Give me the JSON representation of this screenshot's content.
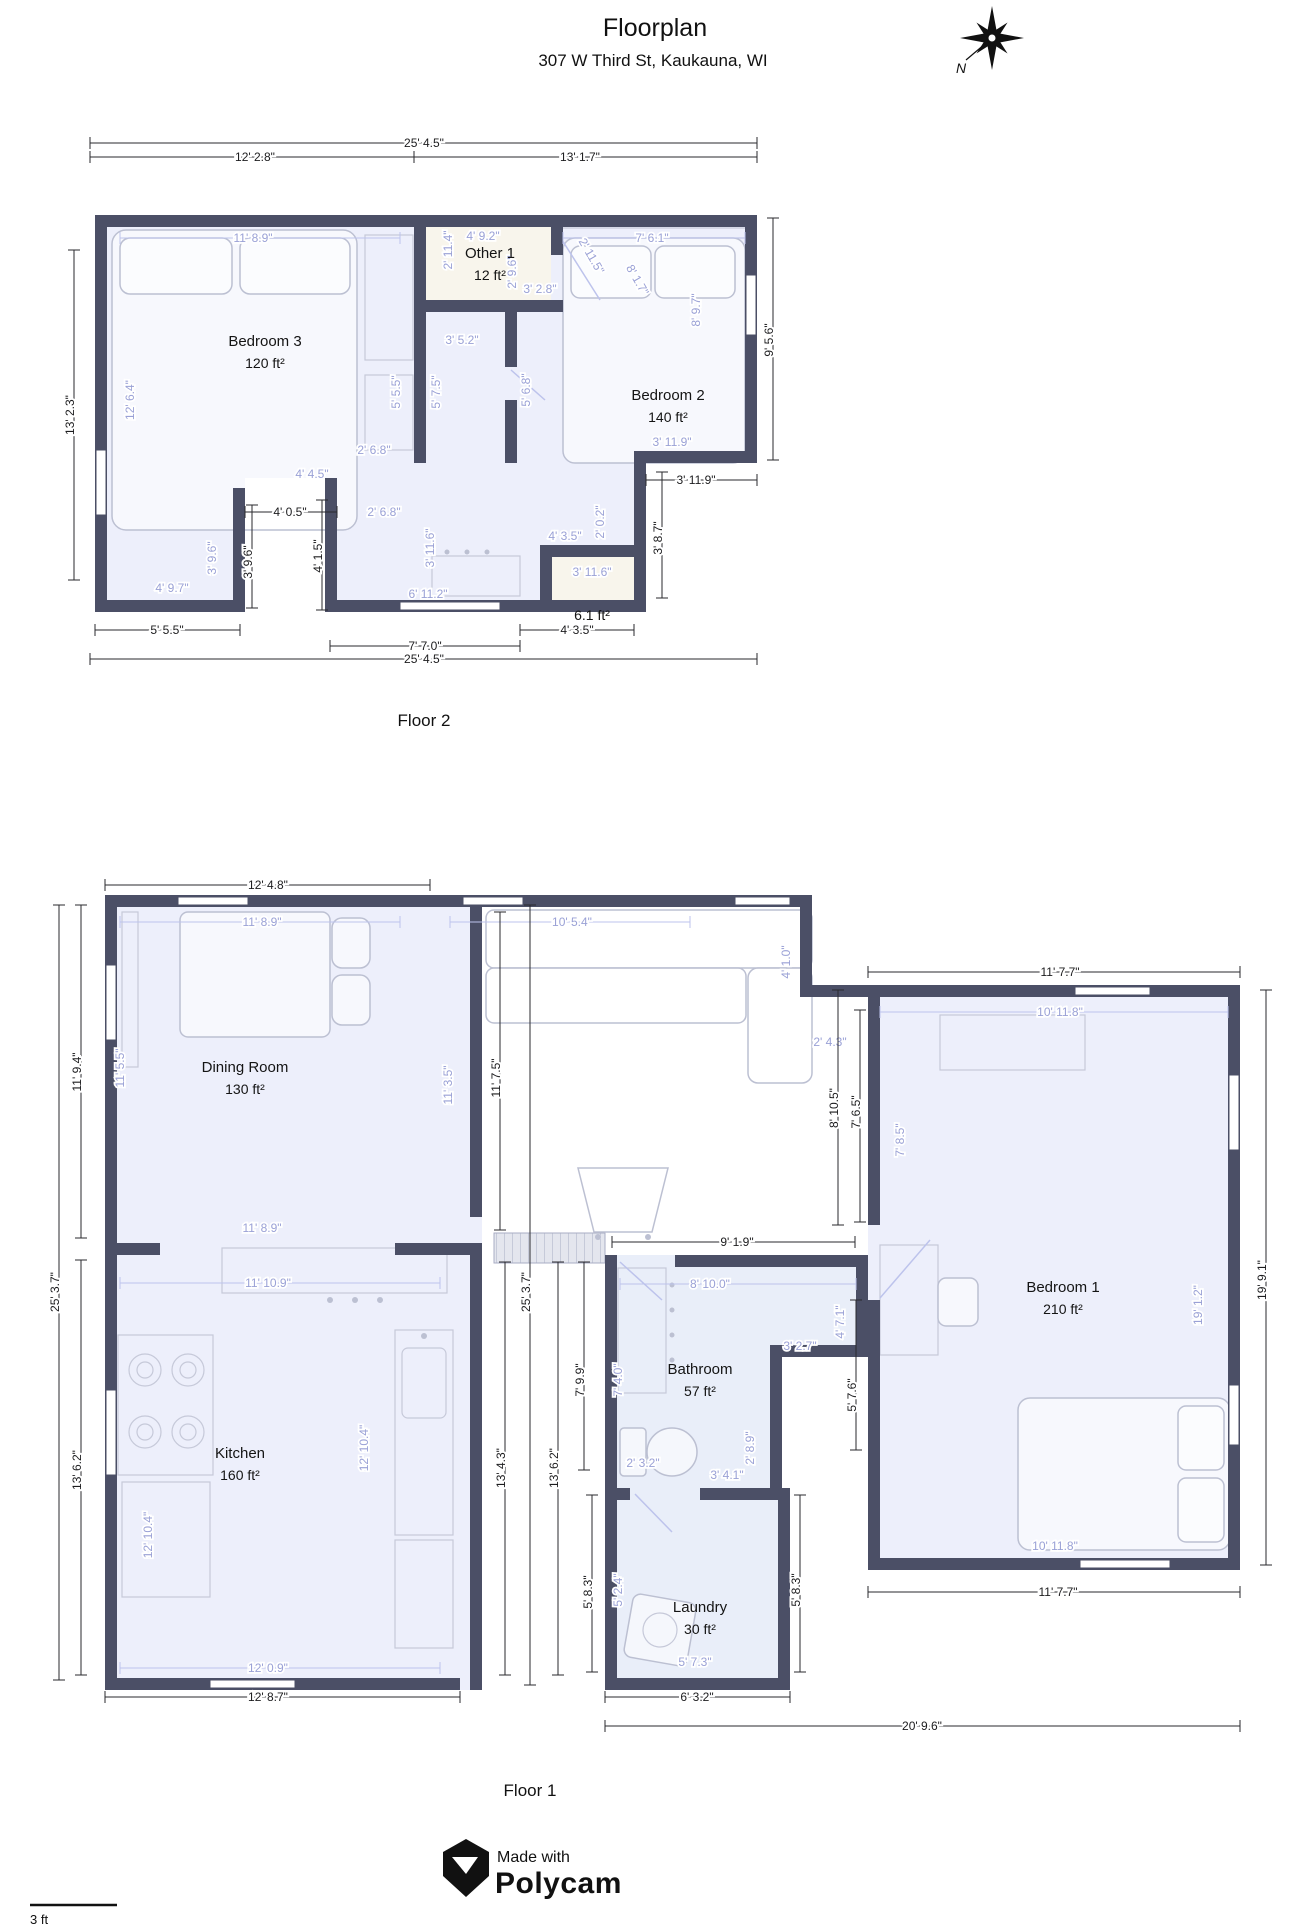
{
  "header": {
    "title": "Floorplan",
    "subtitle": "307 W Third St, Kaukauna, WI"
  },
  "compass": {
    "north_label": "N"
  },
  "colors": {
    "wall": "#4b4f66",
    "dim_black": "#1c1c1e",
    "dim_light": "#9aa1d6",
    "room_fill": "#edeffb",
    "wet_room_fill": "#e9eef9",
    "closet_fill": "#f8f5ec"
  },
  "floor2": {
    "label": "Floor 2",
    "rooms": [
      {
        "name": "Bedroom 3",
        "area": "120 ft²",
        "x": 265,
        "y": 346
      },
      {
        "name": "Other 1",
        "area": "12 ft²",
        "x": 490,
        "y": 258
      },
      {
        "name": "Bedroom 2",
        "area": "140 ft²",
        "x": 668,
        "y": 400
      },
      {
        "name": "",
        "area": "6.1 ft²",
        "x": 592,
        "y": 598
      }
    ],
    "dims": [
      {
        "t": "25' 4.5\"",
        "x": 424,
        "y": 147,
        "c": "b",
        "l": [
          90,
          143,
          757,
          143
        ]
      },
      {
        "t": "12' 2.8\"",
        "x": 255,
        "y": 161,
        "c": "b",
        "l": [
          90,
          157,
          414,
          157
        ]
      },
      {
        "t": "13' 1.7\"",
        "x": 580,
        "y": 161,
        "c": "b",
        "l": [
          414,
          157,
          757,
          157
        ]
      },
      {
        "t": "13' 2.3\"",
        "x": 74,
        "y": 415,
        "r": -90,
        "c": "b",
        "l": [
          74,
          250,
          74,
          580
        ]
      },
      {
        "t": "9' 5.6\"",
        "x": 773,
        "y": 340,
        "r": -90,
        "c": "b",
        "l": [
          773,
          218,
          773,
          460
        ]
      },
      {
        "t": "4' 0.5\"",
        "x": 290,
        "y": 516,
        "c": "b",
        "l": [
          245,
          512,
          337,
          512
        ]
      },
      {
        "t": "4' 1.5\"",
        "x": 322,
        "y": 556,
        "r": -90,
        "c": "b",
        "l": [
          322,
          500,
          322,
          610
        ]
      },
      {
        "t": "3' 9.6\"",
        "x": 252,
        "y": 562,
        "r": -90,
        "c": "b",
        "l": [
          252,
          505,
          252,
          608
        ]
      },
      {
        "t": "3' 9.6\"",
        "x": 216,
        "y": 558,
        "r": -90,
        "c": "l"
      },
      {
        "t": "3' 11.9\"",
        "x": 696,
        "y": 484,
        "c": "b",
        "l": [
          646,
          480,
          757,
          480
        ]
      },
      {
        "t": "3' 11.9\"",
        "x": 672,
        "y": 446,
        "c": "l"
      },
      {
        "t": "3' 8.7\"",
        "x": 662,
        "y": 538,
        "r": -90,
        "c": "b",
        "l": [
          662,
          472,
          662,
          598
        ]
      },
      {
        "t": "5' 5.5\"",
        "x": 167,
        "y": 634,
        "c": "b",
        "l": [
          95,
          630,
          240,
          630
        ]
      },
      {
        "t": "7' 7.0\"",
        "x": 425,
        "y": 650,
        "c": "b",
        "l": [
          330,
          646,
          520,
          646
        ]
      },
      {
        "t": "4' 3.5\"",
        "x": 577,
        "y": 634,
        "c": "b",
        "l": [
          520,
          630,
          634,
          630
        ]
      },
      {
        "t": "25' 4.5\"",
        "x": 424,
        "y": 663,
        "c": "b",
        "l": [
          90,
          659,
          757,
          659
        ]
      },
      {
        "t": "11' 8.9\"",
        "x": 253,
        "y": 242,
        "c": "l",
        "l": [
          120,
          238,
          400,
          238
        ]
      },
      {
        "t": "4' 9.2\"",
        "x": 483,
        "y": 240,
        "c": "l"
      },
      {
        "t": "7' 6.1\"",
        "x": 652,
        "y": 242,
        "c": "l",
        "l": [
          563,
          238,
          745,
          238
        ]
      },
      {
        "t": "2' 11.4\"",
        "x": 452,
        "y": 250,
        "r": -90,
        "c": "l"
      },
      {
        "t": "2' 9.6\"",
        "x": 516,
        "y": 272,
        "r": -90,
        "c": "l"
      },
      {
        "t": "3' 2.8\"",
        "x": 540,
        "y": 293,
        "c": "l"
      },
      {
        "t": "2' 11.5\"",
        "x": 588,
        "y": 258,
        "r": 60,
        "c": "l"
      },
      {
        "t": "8' 1.7\"",
        "x": 634,
        "y": 282,
        "r": 60,
        "c": "l"
      },
      {
        "t": "3' 5.2\"",
        "x": 462,
        "y": 344,
        "c": "l"
      },
      {
        "t": "12' 6.4\"",
        "x": 134,
        "y": 400,
        "r": -90,
        "c": "l"
      },
      {
        "t": "5' 5.5\"",
        "x": 400,
        "y": 392,
        "r": -90,
        "c": "l"
      },
      {
        "t": "5' 7.5\"",
        "x": 440,
        "y": 392,
        "r": -90,
        "c": "l"
      },
      {
        "t": "5' 6.8\"",
        "x": 530,
        "y": 390,
        "r": -90,
        "c": "l"
      },
      {
        "t": "2' 6.8\"",
        "x": 374,
        "y": 454,
        "c": "l"
      },
      {
        "t": "2' 6.8\"",
        "x": 384,
        "y": 516,
        "c": "l"
      },
      {
        "t": "4' 4.5\"",
        "x": 312,
        "y": 478,
        "c": "l"
      },
      {
        "t": "3' 11.6\"",
        "x": 434,
        "y": 548,
        "r": -90,
        "c": "l"
      },
      {
        "t": "6' 11.2\"",
        "x": 428,
        "y": 598,
        "c": "l"
      },
      {
        "t": "4' 9.7\"",
        "x": 172,
        "y": 592,
        "c": "l"
      },
      {
        "t": "3' 11.6\"",
        "x": 592,
        "y": 576,
        "c": "l"
      },
      {
        "t": "4' 3.5\"",
        "x": 565,
        "y": 540,
        "c": "l"
      },
      {
        "t": "2' 0.2\"",
        "x": 604,
        "y": 522,
        "r": -90,
        "c": "l"
      },
      {
        "t": "8' 9.7\"",
        "x": 700,
        "y": 310,
        "r": -90,
        "c": "l"
      }
    ]
  },
  "floor1": {
    "label": "Floor 1",
    "rooms": [
      {
        "name": "Dining Room",
        "area": "130 ft²",
        "x": 245,
        "y": 1072
      },
      {
        "name": "Kitchen",
        "area": "160 ft²",
        "x": 240,
        "y": 1458
      },
      {
        "name": "Bathroom",
        "area": "57 ft²",
        "x": 700,
        "y": 1374
      },
      {
        "name": "Laundry",
        "area": "30 ft²",
        "x": 700,
        "y": 1612
      },
      {
        "name": "Bedroom 1",
        "area": "210 ft²",
        "x": 1063,
        "y": 1292
      }
    ],
    "dims": [
      {
        "t": "12' 4.8\"",
        "x": 268,
        "y": 889,
        "c": "b",
        "l": [
          105,
          885,
          430,
          885
        ]
      },
      {
        "t": "25' 3.7\"",
        "x": 59,
        "y": 1292,
        "r": -90,
        "c": "b",
        "l": [
          59,
          905,
          59,
          1680
        ]
      },
      {
        "t": "11' 9.4\"",
        "x": 81,
        "y": 1072,
        "r": -90,
        "c": "b",
        "l": [
          81,
          905,
          81,
          1238
        ]
      },
      {
        "t": "13' 6.2\"",
        "x": 81,
        "y": 1470,
        "r": -90,
        "c": "b",
        "l": [
          81,
          1260,
          81,
          1675
        ]
      },
      {
        "t": "11' 8.9\"",
        "x": 262,
        "y": 926,
        "c": "l",
        "l": [
          120,
          922,
          400,
          922
        ]
      },
      {
        "t": "10' 5.4\"",
        "x": 572,
        "y": 926,
        "c": "l",
        "l": [
          450,
          922,
          690,
          922
        ]
      },
      {
        "t": "11' 5.5\"",
        "x": 124,
        "y": 1068,
        "r": -90,
        "c": "l"
      },
      {
        "t": "11' 8.9\"",
        "x": 262,
        "y": 1232,
        "c": "l"
      },
      {
        "t": "11' 3.5\"",
        "x": 452,
        "y": 1085,
        "r": -90,
        "c": "l"
      },
      {
        "t": "11' 7.5\"",
        "x": 500,
        "y": 1078,
        "r": -90,
        "c": "b",
        "l": [
          500,
          912,
          500,
          1230
        ]
      },
      {
        "t": "4' 1.0\"",
        "x": 790,
        "y": 962,
        "r": -90,
        "c": "l"
      },
      {
        "t": "2' 4.3\"",
        "x": 830,
        "y": 1046,
        "c": "l"
      },
      {
        "t": "8' 10.5\"",
        "x": 838,
        "y": 1108,
        "r": -90,
        "c": "b",
        "l": [
          838,
          990,
          838,
          1225
        ]
      },
      {
        "t": "7' 6.5\"",
        "x": 860,
        "y": 1112,
        "r": -90,
        "c": "b",
        "l": [
          860,
          1010,
          860,
          1222
        ]
      },
      {
        "t": "11' 7.7\"",
        "x": 1060,
        "y": 976,
        "c": "b",
        "l": [
          868,
          972,
          1240,
          972
        ]
      },
      {
        "t": "10' 11.8\"",
        "x": 1060,
        "y": 1016,
        "c": "l",
        "l": [
          880,
          1012,
          1228,
          1012
        ]
      },
      {
        "t": "7' 8.5\"",
        "x": 904,
        "y": 1140,
        "r": -90,
        "c": "l"
      },
      {
        "t": "19' 1.2\"",
        "x": 1202,
        "y": 1305,
        "r": -90,
        "c": "l"
      },
      {
        "t": "19' 9.1\"",
        "x": 1266,
        "y": 1280,
        "r": -90,
        "c": "b",
        "l": [
          1266,
          990,
          1266,
          1565
        ]
      },
      {
        "t": "10' 11.8\"",
        "x": 1055,
        "y": 1550,
        "c": "l"
      },
      {
        "t": "11' 7.7\"",
        "x": 1058,
        "y": 1596,
        "c": "b",
        "l": [
          868,
          1592,
          1240,
          1592
        ]
      },
      {
        "t": "5' 7.6\"",
        "x": 856,
        "y": 1395,
        "r": -90,
        "c": "b",
        "l": [
          856,
          1300,
          856,
          1450
        ]
      },
      {
        "t": "9' 1.9\"",
        "x": 737,
        "y": 1246,
        "c": "b",
        "l": [
          612,
          1242,
          855,
          1242
        ]
      },
      {
        "t": "8' 10.0\"",
        "x": 710,
        "y": 1288,
        "c": "l",
        "l": [
          620,
          1284,
          856,
          1284
        ]
      },
      {
        "t": "7' 4.0\"",
        "x": 622,
        "y": 1380,
        "r": -90,
        "c": "l"
      },
      {
        "t": "4' 7.1\"",
        "x": 844,
        "y": 1322,
        "r": -90,
        "c": "l"
      },
      {
        "t": "3' 2.7\"",
        "x": 800,
        "y": 1350,
        "c": "l"
      },
      {
        "t": "2' 8.9\"",
        "x": 754,
        "y": 1448,
        "r": -90,
        "c": "l"
      },
      {
        "t": "3' 4.1\"",
        "x": 727,
        "y": 1479,
        "c": "l"
      },
      {
        "t": "2' 3.2\"",
        "x": 643,
        "y": 1467,
        "c": "l"
      },
      {
        "t": "25' 3.7\"",
        "x": 530,
        "y": 1292,
        "r": -90,
        "c": "b",
        "l": [
          530,
          905,
          530,
          1685
        ]
      },
      {
        "t": "13' 4.3\"",
        "x": 505,
        "y": 1468,
        "r": -90,
        "c": "b",
        "l": [
          505,
          1262,
          505,
          1675
        ]
      },
      {
        "t": "13' 6.2\"",
        "x": 558,
        "y": 1468,
        "r": -90,
        "c": "b",
        "l": [
          558,
          1262,
          558,
          1675
        ]
      },
      {
        "t": "7' 9.9\"",
        "x": 584,
        "y": 1380,
        "r": -90,
        "c": "b",
        "l": [
          584,
          1262,
          584,
          1470
        ]
      },
      {
        "t": "11' 10.9\"",
        "x": 268,
        "y": 1287,
        "c": "l",
        "l": [
          120,
          1283,
          440,
          1283
        ]
      },
      {
        "t": "12' 10.4\"",
        "x": 152,
        "y": 1535,
        "r": -90,
        "c": "l"
      },
      {
        "t": "12' 10.4\"",
        "x": 368,
        "y": 1448,
        "r": -90,
        "c": "l"
      },
      {
        "t": "12' 0.9\"",
        "x": 268,
        "y": 1672,
        "c": "l",
        "l": [
          120,
          1668,
          440,
          1668
        ]
      },
      {
        "t": "12' 8.7\"",
        "x": 268,
        "y": 1701,
        "c": "b",
        "l": [
          105,
          1697,
          460,
          1697
        ]
      },
      {
        "t": "5' 8.3\"",
        "x": 592,
        "y": 1592,
        "r": -90,
        "c": "b",
        "l": [
          592,
          1495,
          592,
          1672
        ]
      },
      {
        "t": "5' 2.4\"",
        "x": 622,
        "y": 1590,
        "r": -90,
        "c": "l"
      },
      {
        "t": "5' 8.3\"",
        "x": 800,
        "y": 1590,
        "r": -90,
        "c": "b",
        "l": [
          800,
          1495,
          800,
          1672
        ]
      },
      {
        "t": "5' 7.3\"",
        "x": 695,
        "y": 1666,
        "c": "l"
      },
      {
        "t": "6' 3.2\"",
        "x": 697,
        "y": 1701,
        "c": "b",
        "l": [
          605,
          1697,
          790,
          1697
        ]
      },
      {
        "t": "20' 9.6\"",
        "x": 922,
        "y": 1730,
        "c": "b",
        "l": [
          605,
          1726,
          1240,
          1726
        ]
      }
    ]
  },
  "footer": {
    "made_with": "Made with",
    "brand": "Polycam",
    "scale_label": "3 ft"
  }
}
